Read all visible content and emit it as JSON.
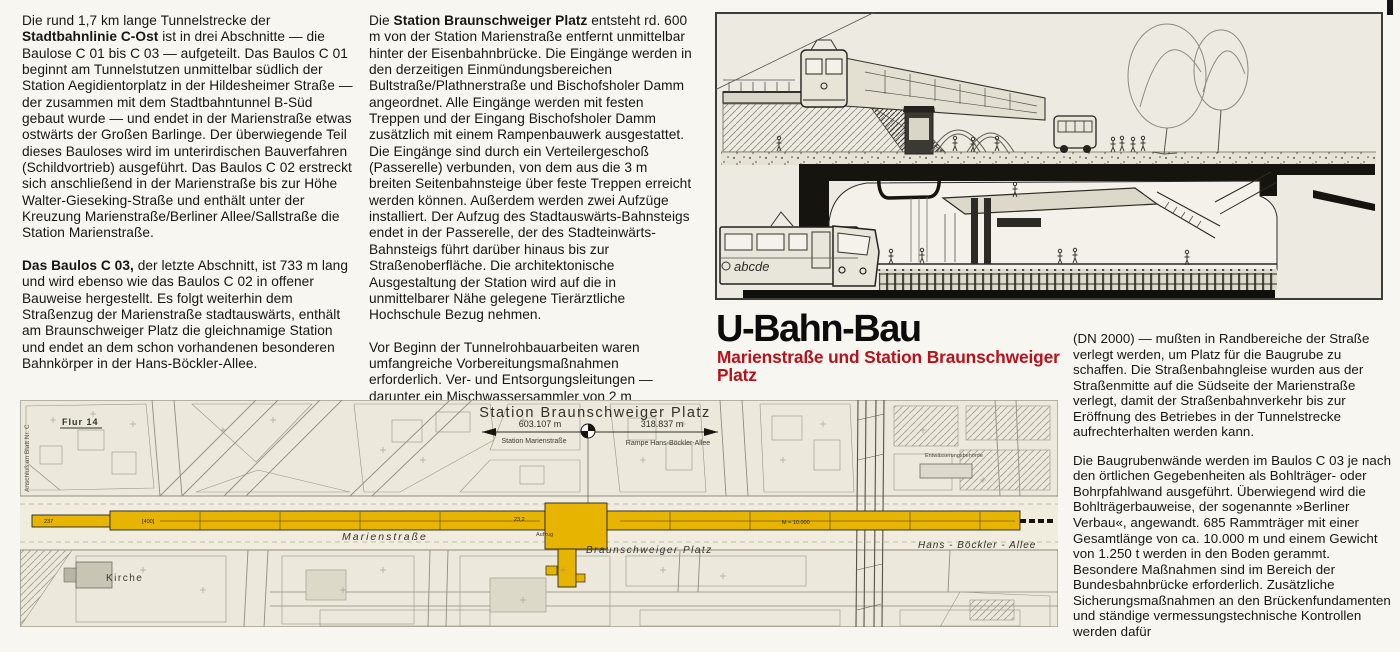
{
  "header": {
    "title": "U-Bahn-Bau",
    "subtitle": "Marienstraße und Station Braunschweiger Platz",
    "subtitle_color": "#b5121c"
  },
  "article": {
    "col1": {
      "p1_pre": "Die rund 1,7 km lange Tunnelstrecke der ",
      "p1_bold": "Stadtbahnlinie C-Ost",
      "p1_post": " ist in drei Abschnitte — die Baulose C 01 bis C 03 — aufgeteilt. Das Baulos C 01 beginnt am Tunnelstutzen unmittelbar südlich der Station Aegidientorplatz in der Hildesheimer Straße — der zusammen mit dem Stadtbahntunnel B-Süd gebaut wurde — und endet in der Marienstraße etwas ostwärts der Großen Barlinge. Der überwiegende Teil dieses Bauloses wird im unterirdischen Bauverfahren (Schildvortrieb) ausgeführt. Das Baulos C 02 erstreckt sich anschließend in der Marienstraße bis zur Höhe Walter-Gieseking-Straße und enthält unter der Kreuzung Marienstraße/Berliner Allee/Sallstraße die Station Marienstraße.",
      "p2_bold": "Das Baulos C 03,",
      "p2_post": " der letzte Abschnitt, ist 733 m lang und wird ebenso wie das Baulos C 02 in offener Bauweise hergestellt. Es folgt weiterhin dem Straßenzug der Marienstraße stadtauswärts, enthält am Braunschweiger Platz die gleichnamige Station und endet an dem schon vorhandenen besonderen Bahnkörper in der Hans-Böckler-Allee."
    },
    "col2": {
      "p1_pre": "Die ",
      "p1_bold": "Station Braunschweiger Platz",
      "p1_post": " entsteht rd. 600 m von der Station Marienstraße entfernt unmittelbar hinter der Eisenbahnbrücke. Die Eingänge werden in den derzeitigen Einmündungsbereichen Bultstraße/Plathnerstraße und Bischofsholer Damm angeordnet. Alle Eingänge werden mit festen Treppen und der Eingang Bischofsholer Damm zusätzlich mit einem Rampenbauwerk ausgestattet. Die Eingänge sind durch ein Verteilergeschoß (Passerelle) verbunden, von dem aus die 3 m breiten Seitenbahnsteige über feste Treppen erreicht werden können. Außerdem werden zwei Aufzüge installiert. Der Aufzug des Stadtauswärts-Bahnsteigs endet in der Passerelle, der des Stadteinwärts-Bahnsteigs führt darüber hinaus bis zur Straßenoberfläche. Die architektonische Ausgestaltung der Station wird auf die in unmittelbarer Nähe gelegene Tierärztliche Hochschule Bezug nehmen.",
      "p2": "Vor Beginn der Tunnelrohbauarbeiten waren umfangreiche Vorbereitungsmaßnahmen erforderlich. Ver- und Entsorgungsleitungen — darunter ein Mischwassersammler von 2 m Durchmesser"
    },
    "col3": {
      "p1": "(DN 2000) — mußten in Randbereiche der Straße verlegt werden, um Platz für die Baugrube zu schaffen. Die Straßenbahngleise wurden aus der Straßenmitte auf die Südseite der Marienstraße verlegt, damit der Straßenbahnverkehr bis zur Eröffnung des Betriebes in der Tunnelstrecke aufrechterhalten werden kann.",
      "p2": "Die Baugrubenwände werden im Baulos C 03 je nach den örtlichen Gegebenheiten als Bohlträger- oder Bohrpfahlwand ausgeführt. Überwiegend wird die Bohlträgerbauweise, der sogenannte »Berliner Verbau«, angewandt. 685 Rammträger mit einer Gesamtlänge von ca. 10.000 m und einem Gewicht von 1.250 t werden in den Boden gerammt. Besondere Maßnahmen sind im Bereich der Bundesbahnbrücke erforderlich. Zusätzliche Sicherungsmaßnahmen an den Brückenfundamenten und ständige vermessungstechnische Kontrollen werden dafür"
    }
  },
  "illustration": {
    "train_letters": "abcde"
  },
  "map": {
    "header": "Station Braunschweiger Platz",
    "dim_left_value": "603.107 m",
    "dim_left_label": "Station Marienstraße",
    "dim_right_value": "318.837 m",
    "dim_right_label": "Rampe Hans-Böckler-Allee",
    "flur_label": "Flur 14",
    "kirche_label": "Kirche",
    "marienstrasse_label": "Marienstraße",
    "braunschweiger_platz_label": "Braunschweiger Platz",
    "hans_boeckler_label": "Hans - Böckler - Allee",
    "anschluss_label": "Anschluß an Blatt Nr. C",
    "behoerde_label": "Entwässerungsbehörde",
    "scale_label": "M = 10.000",
    "aufzug_label": "Aufzug",
    "band_marks": [
      "237",
      "[400]",
      "23,2"
    ],
    "route_color": "#e7b501"
  }
}
